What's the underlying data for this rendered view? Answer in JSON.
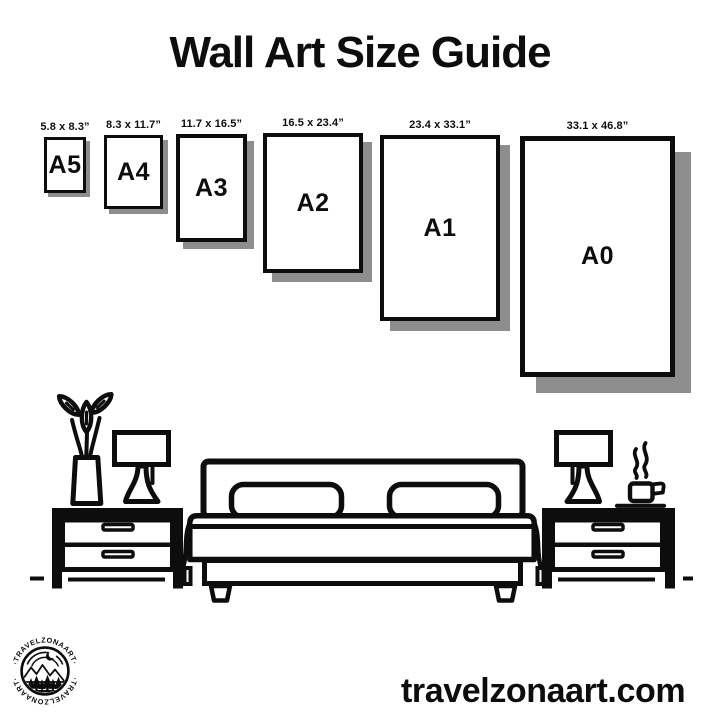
{
  "title": "Wall Art Size Guide",
  "size_guide": {
    "items": [
      {
        "name": "A5",
        "dimensions": "5.8 x 8.3”",
        "x": 44,
        "top": 137,
        "width": 42,
        "height": 56,
        "shadow": 4,
        "border": 3
      },
      {
        "name": "A4",
        "dimensions": "8.3 x 11.7”",
        "x": 104,
        "top": 135,
        "width": 59,
        "height": 74,
        "shadow": 5,
        "border": 3
      },
      {
        "name": "A3",
        "dimensions": "11.7 x 16.5”",
        "x": 176,
        "top": 134,
        "width": 71,
        "height": 108,
        "shadow": 7,
        "border": 4
      },
      {
        "name": "A2",
        "dimensions": "16.5 x 23.4”",
        "x": 263,
        "top": 133,
        "width": 100,
        "height": 140,
        "shadow": 9,
        "border": 4
      },
      {
        "name": "A1",
        "dimensions": "23.4 x 33.1”",
        "x": 380,
        "top": 135,
        "width": 120,
        "height": 186,
        "shadow": 10,
        "border": 4
      },
      {
        "name": "A0",
        "dimensions": "33.1 x 46.8”",
        "x": 520,
        "top": 136,
        "width": 155,
        "height": 241,
        "shadow": 16,
        "border": 5
      }
    ]
  },
  "footer": {
    "website": "travelzonaart.com"
  },
  "logo": {
    "brand_top": "·TRAVELZONAART·",
    "brand_bottom": "·TRAVELZONAART·"
  },
  "colors": {
    "ink": "#0d0d0d",
    "shadow": "#8d8d8d",
    "background": "#ffffff"
  }
}
